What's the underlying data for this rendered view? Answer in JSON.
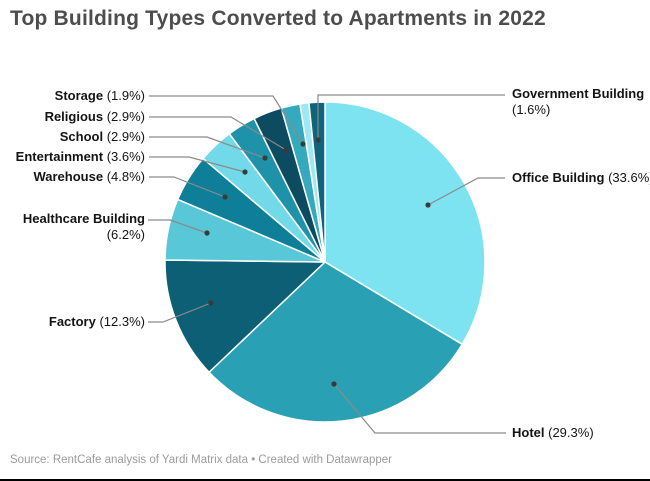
{
  "title": "Top Building Types Converted to Apartments in 2022",
  "footer": {
    "source": "Source: RentCafe analysis of Yardi Matrix data • Created with Datawrapper"
  },
  "chart_data": {
    "type": "pie",
    "title": "Top Building Types Converted to Apartments in 2022",
    "legend_position": "none",
    "label_style": "external-callouts-with-leader-lines",
    "start_angle_deg": 0,
    "direction": "clockwise",
    "segments": [
      {
        "label": "Office Building",
        "pct": "(33.6%)",
        "value": 33.6,
        "color": "#7DE3F1"
      },
      {
        "label": "Hotel",
        "pct": "(29.3%)",
        "value": 29.3,
        "color": "#29A0B3"
      },
      {
        "label": "Factory",
        "pct": "(12.3%)",
        "value": 12.3,
        "color": "#0D5F76"
      },
      {
        "label": "Healthcare Building",
        "pct": "(6.2%)",
        "value": 6.2,
        "color": "#58C7D7"
      },
      {
        "label": "Warehouse",
        "pct": "(4.8%)",
        "value": 4.8,
        "color": "#0F7F99"
      },
      {
        "label": "Entertainment",
        "pct": "(3.6%)",
        "value": 3.6,
        "color": "#72D9E8"
      },
      {
        "label": "School",
        "pct": "(2.9%)",
        "value": 2.9,
        "color": "#1D92A9"
      },
      {
        "label": "Religious",
        "pct": "(2.9%)",
        "value": 2.9,
        "color": "#0C4B60"
      },
      {
        "label": "Storage",
        "pct": "(1.9%)",
        "value": 1.9,
        "color": "#35AABF"
      },
      {
        "label": "",
        "pct": "",
        "value": 0.9,
        "color": "#9DE8F2"
      },
      {
        "label": "Government Building",
        "pct": "(1.6%)",
        "value": 1.6,
        "color": "#0F637B"
      }
    ]
  }
}
